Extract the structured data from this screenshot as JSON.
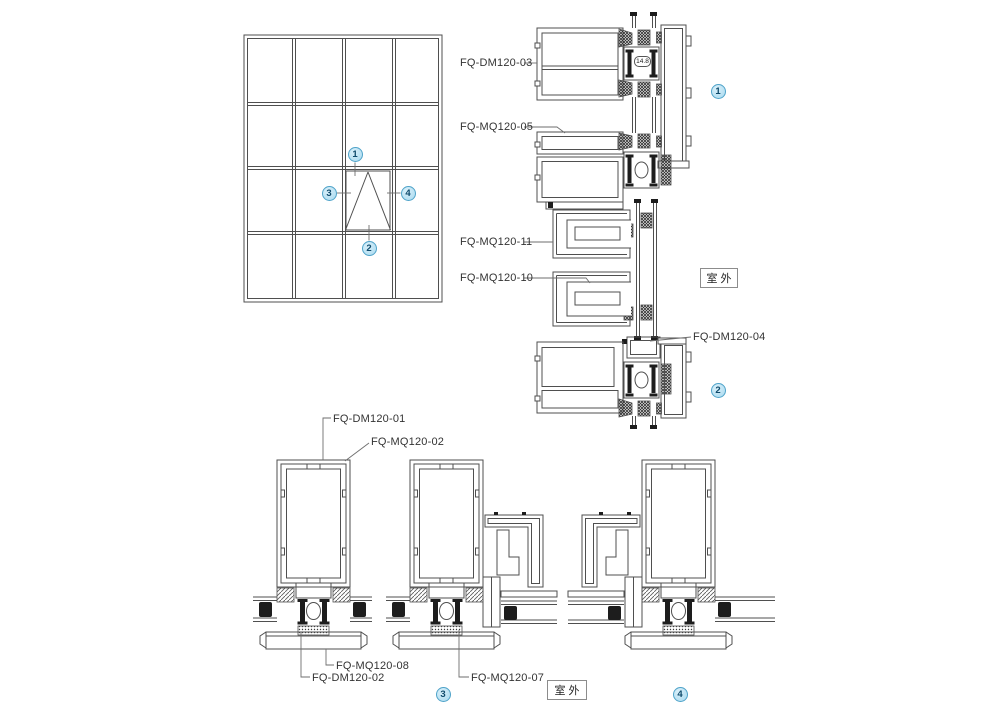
{
  "colors": {
    "line": "#4f4f4f",
    "leader": "#6e6e6e",
    "label_text": "#333333",
    "callout_fill": "#a8d9ef",
    "callout_border": "#4fa3c9",
    "callout_text": "#0e4a6b",
    "outdoor_border": "#8c8c8c"
  },
  "labels": {
    "fq_dm120_03": "FQ-DM120-03",
    "fq_mq120_05": "FQ-MQ120-05",
    "fq_mq120_11": "FQ-MQ120-11",
    "fq_mq120_10": "FQ-MQ120-10",
    "fq_dm120_04": "FQ-DM120-04",
    "fq_dm120_01": "FQ-DM120-01",
    "fq_mq120_02": "FQ-MQ120-02",
    "fq_mq120_08": "FQ-MQ120-08",
    "fq_dm120_02": "FQ-DM120-02",
    "fq_mq120_07": "FQ-MQ120-07"
  },
  "annotations": {
    "outdoor_top": "室外",
    "outdoor_bottom": "室外",
    "dimension": "14.8"
  },
  "callouts": {
    "c1": "1",
    "c2": "2",
    "c3": "3",
    "c4": "4"
  }
}
